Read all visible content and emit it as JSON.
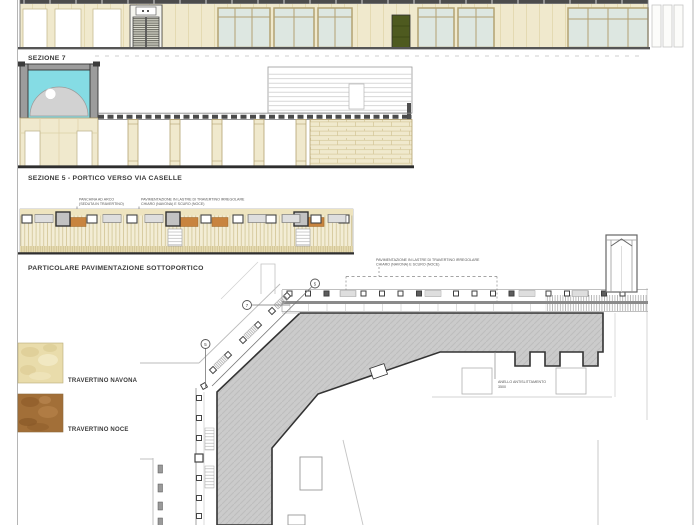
{
  "palette": {
    "ink": "#3a3a3a",
    "beige": "#f0e9cd",
    "tan": "#b3a272",
    "glass": "#dde7e1",
    "louver": "#5c5c50",
    "greenDoor": "#4e5a1f",
    "vaultCyan": "#85dce4",
    "domeGray": "#d2d2d2",
    "pocheGray": "#9c9c9c",
    "planGray": "#cbcbcb",
    "planEdge": "#333333",
    "orange": "#c8843f",
    "navona": "#e9dcab",
    "noce": "#a26f38",
    "pave": "#f3edd5"
  },
  "labels": {
    "section7": "SEZIONE 7",
    "section5": "SEZIONE 5 - PORTICO VERSO VIA CASELLE",
    "detail": "PARTICOLARE PAVIMENTAZIONE SOTTOPORTICO"
  },
  "materials": [
    {
      "name": "TRAVERTINO NAVONA"
    },
    {
      "name": "TRAVERTINO NOCE"
    }
  ],
  "annotations": {
    "bench": [
      "PANCHINA AD ARCO",
      "(SEDUTA IN TRAVERTINO)"
    ],
    "paving": [
      "PAVIMENTAZIONE IN LASTRE DI TRAVERTINO IRREGOLARE",
      "CHIARO (NAVONA) E SCURO (NOCE)"
    ],
    "plan_paving": [
      "PAVIMENTAZIONE IN LASTRE DI TRAVERTINO IRREGOLARE",
      "CHIARO (NAVONA) E SCURO (NOCE)"
    ],
    "plan_note": [
      "ANELLO ANTISLITTAMENTO",
      "3500"
    ]
  },
  "plan_markers": [
    "7",
    "5",
    "5"
  ]
}
